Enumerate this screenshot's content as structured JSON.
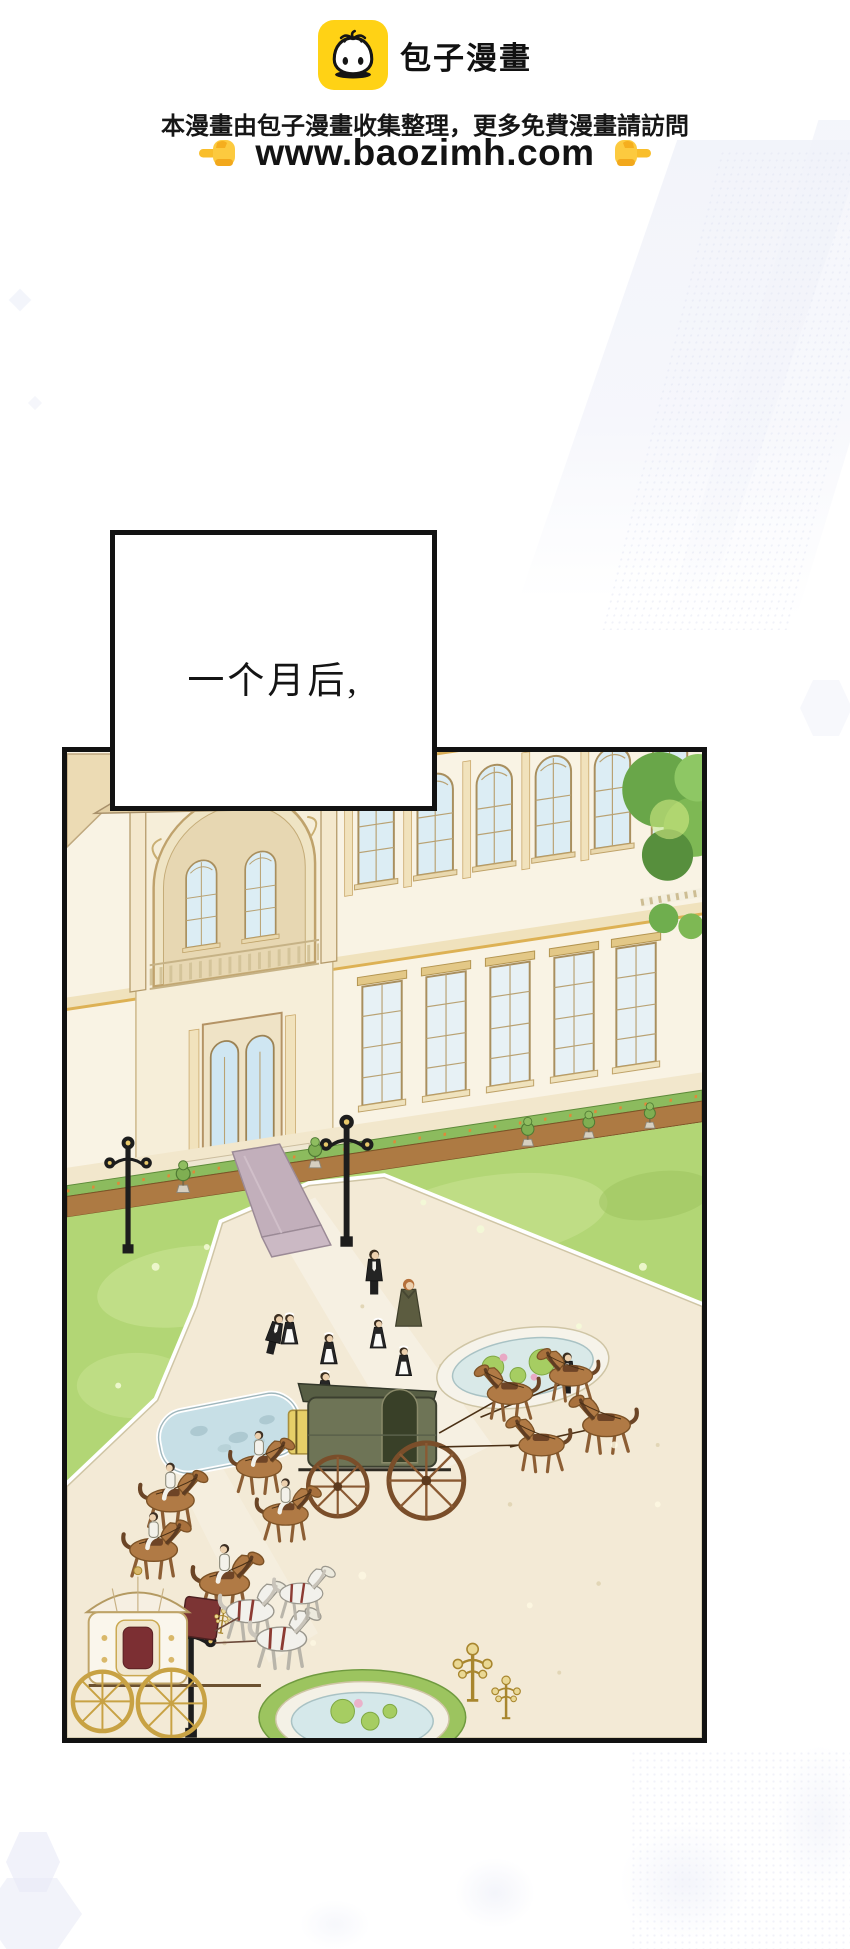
{
  "header": {
    "logo": {
      "icon": "baozi-bun-icon",
      "bg_color": "#FFD215",
      "title": "包子漫畫"
    },
    "notice": "本漫畫由包子漫畫收集整理，更多免費漫畫請訪問",
    "url_line": {
      "left_icon": "pointing-right-hand-icon",
      "url": "www.baozimh.com",
      "right_icon": "pointing-left-hand-icon",
      "hand_color": "#F9BE2B"
    }
  },
  "caption": {
    "text": "一个月后,"
  },
  "panel": {
    "alt": "Aerial comic panel: grand cream palace with gold trim and arched windows; mauve carpet down the entrance steps; green lawns and a stone plaza where butlers and maids line up; a dark-green carriage with a yellow chest pulled by brown horses; riders in white on brown horses; an ornate white-and-gold domed carriage with white horses; stone ponds with lily pads; black lamp posts and golden candelabra",
    "palette": {
      "panel_border": "#121212",
      "wall": "#f9f3e4",
      "gold_trim": "#d9b165",
      "lawn": "#b2d675",
      "pavement": "#f3ead6",
      "carpet": "#c2afbb",
      "window_glass": "#dcedf4",
      "water": "#d5e8ea",
      "horse_brown": "#b07a45",
      "carriage_green": "#6e7456",
      "chest_yellow": "#e6cf68",
      "white_carriage": "#faf6ec",
      "tree_green": "#69a649"
    }
  },
  "background": {
    "decor_color": "#e8ebf6"
  }
}
